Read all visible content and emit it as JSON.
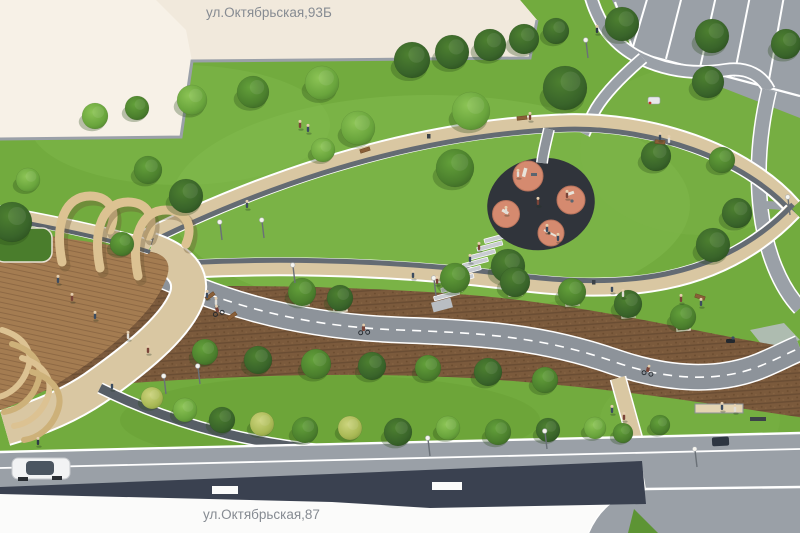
{
  "labels": {
    "building_top": "ул.Октябрьская,93Б",
    "building_bottom": "ул.Октябрьская,87"
  },
  "palette": {
    "lawn": "#72ab3e",
    "lawn_light": "#85bc50",
    "path_beige": "#d9c7a2",
    "paving_dark": "#5d646c",
    "mulch": "#7b5a3c",
    "asphalt": "#9aa0a7",
    "bike_path": "#8d939a",
    "playground_surface": "#30343b",
    "playground_pads": "#d58a6f",
    "building_cream": "#f7f1e7",
    "roof_white": "#fbfbfa",
    "roof_dark": "#3a4150",
    "wood_deck": "#a47c51",
    "wood_light": "#dcc292",
    "line_white": "#ffffff",
    "label_gray": "#868b92"
  }
}
